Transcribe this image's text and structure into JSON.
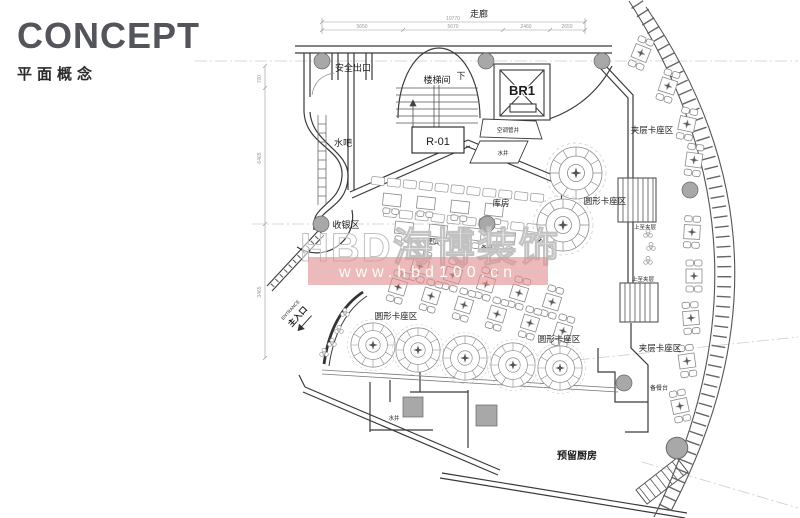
{
  "header": {
    "title": "CONCEPT",
    "subtitle": "平面概念"
  },
  "plan": {
    "corridor": "走廊",
    "safety_exit": "安全出口",
    "stairwell": "楼梯间",
    "stair_down": "下",
    "elevator": "BR1",
    "room_code": "R-01",
    "ac_shaft": "空调管井",
    "water_shaft": "水井",
    "water_bar": "水吧",
    "cashier": "收银区",
    "storage": "库房",
    "multi_booth": "多人卡座区",
    "prep_counter_mid": "备餐台",
    "round_booth": "圆形卡座区",
    "mezz_booth": "夹层卡座区",
    "up_to_mezz": "上至夹层",
    "prep_counter": "备餐台",
    "entrance_en": "ENTRANCE",
    "entrance_cn": "主入口",
    "kitchen": "预留厨房",
    "water_well": "水井"
  },
  "dimensions": {
    "top_total": "10770",
    "top_segments": [
      "5650",
      "5670",
      "2460",
      "2650"
    ],
    "left_segments": [
      "700",
      "6465",
      "3465"
    ]
  },
  "watermark": {
    "brand": "HBD海博装饰",
    "url": "www.hbd100.cn",
    "band_color": "#e08f8f"
  },
  "colors": {
    "ink": "#3a3a3a",
    "furniture": "#8a8a8a",
    "column_fill": "#a8a8a8",
    "grid": "#cccccc"
  }
}
